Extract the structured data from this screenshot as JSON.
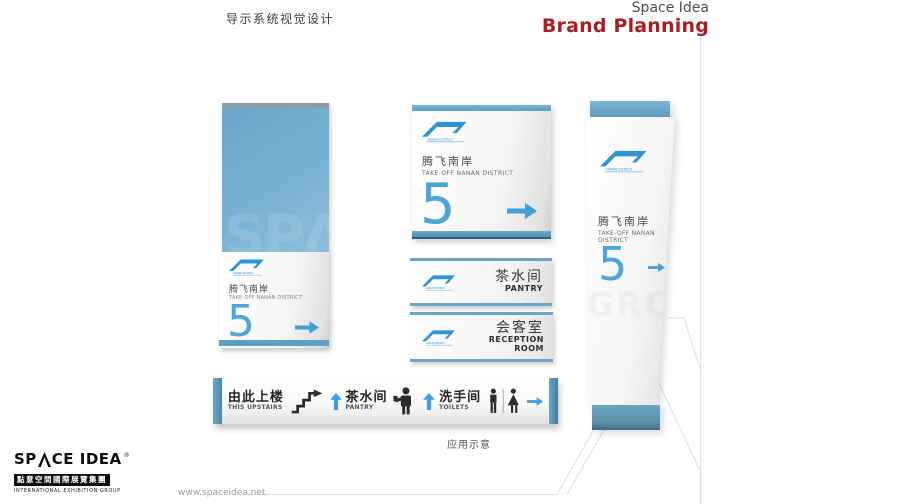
{
  "header": {
    "title": "导示系统视觉设计",
    "brand_name": "Space Idea",
    "brand_tagline": "Brand Planning"
  },
  "district": {
    "cn": "腾飞南岸",
    "en": "TAKE-OFF NANAN DISTRICT",
    "number": "5",
    "logo_caption": "NANAN DISTRICT"
  },
  "rooms": {
    "pantry": {
      "cn": "茶水间",
      "en": "PANTRY"
    },
    "reception": {
      "cn": "会客室",
      "en": "RECEPTION ROOM"
    }
  },
  "directory": {
    "items": [
      {
        "cn": "由此上楼",
        "en": "THIS UPSTAIRS",
        "icon": "stairs-icon",
        "arrow": "up"
      },
      {
        "cn": "茶水间",
        "en": "PANTRY",
        "icon": "person-cup-icon",
        "arrow": "up"
      },
      {
        "cn": "洗手间",
        "en": "TOILETS",
        "icon": "mens-womens-icon",
        "arrow": "right"
      }
    ]
  },
  "caption": "应用示意",
  "watermark_text": "SPΛ",
  "footer": {
    "logo_sp": "SP",
    "logo_rest": "CE IDEA",
    "logo_reg": "®",
    "logo_cn": "點意空間國際展覽集團",
    "logo_en": "INTERNATIONAL EXHIBITION GROUP",
    "website": "www.spaceidea.net"
  },
  "colors": {
    "accent_blue": "#4da4d6",
    "bar_blue": "#5e9cc0",
    "panel_blue": "#79b1d3",
    "brand_red": "#a91d23",
    "icon_dark": "#2c2c2c",
    "guide_line": "#e3e3e3"
  }
}
